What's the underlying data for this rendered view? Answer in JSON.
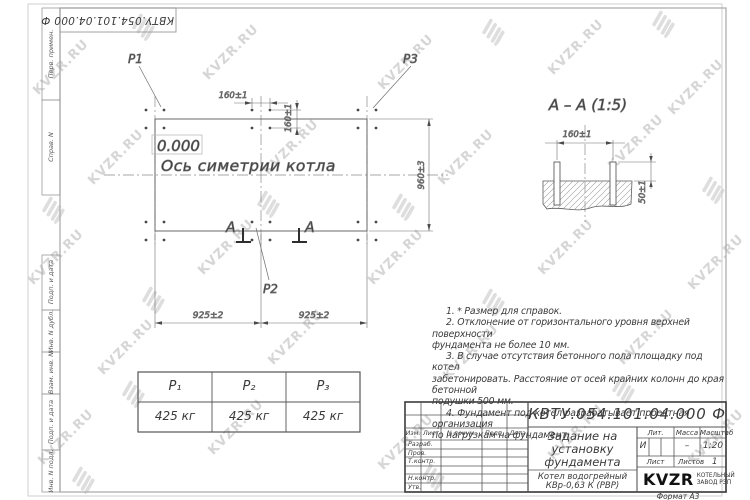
{
  "watermark": {
    "text": "KVZR.RU"
  },
  "corner_stamp": {
    "doc_number": "КВТУ.054.101.04.000  Ф"
  },
  "sidebar": {
    "labels": [
      "Перв. примен.",
      "Справ. N",
      "Подп. и дата",
      "Инв. N дубл.",
      "Взам. инв. N",
      "Подп. и дата",
      "Инв. N подл."
    ]
  },
  "plan": {
    "labels": {
      "p1": "P1",
      "p2": "P2",
      "p3": "P3",
      "level": "0.000",
      "axis": "Ось симетрии котла",
      "section_letter_left": "А",
      "section_letter_right": "А"
    },
    "dims": {
      "top_h": "160±1",
      "top_v": "160±1",
      "right_v": "960±3",
      "bottom_left": "925±2",
      "bottom_right": "925±2"
    }
  },
  "section": {
    "title": "А – А (1:5)",
    "dim_width": "160±1",
    "dim_height": "50±1"
  },
  "notes": {
    "lines": [
      "1. * Размер для справок.",
      "2. Отклонение от горизонтального уровня верхней поверхности",
      "фундамента не более 10 мм.",
      "3. В случае отсутствия бетонного пола площадку под котел",
      "забетонировать. Расстояние от осей крайних колонн до края бетонной",
      "подушки 500 мм.",
      "4. Фундамент под котел разрабатывает проектная организация",
      "по нагрузкам на фундамент."
    ]
  },
  "load_table": {
    "headers": [
      "P₁",
      "P₂",
      "P₃"
    ],
    "values": [
      "425 кг",
      "425 кг",
      "425 кг"
    ]
  },
  "title_block": {
    "doc_number": "КВТУ.054.101.04.000  Ф",
    "title_lines": [
      "Задание на",
      "установку",
      "фундамента"
    ],
    "product_lines": [
      "Котел водогрейный",
      "КВр-0,63 К (РВР)"
    ],
    "col_headers": [
      "Изм.",
      "Лист",
      "N докум.",
      "Подп.",
      "Дата"
    ],
    "row_labels": [
      "Разраб.",
      "Пров.",
      "Т.контр.",
      "Н.контр.",
      "Утв."
    ],
    "lit_label": "Лит.",
    "mass_label": "Масса",
    "scale_label": "Масштаб",
    "lit_value": "И",
    "mass_value": "–",
    "scale_value": "1:20",
    "sheet_label": "Лист",
    "sheets_label": "Листов",
    "sheets_value": "1",
    "logo_text": "KVZR",
    "logo_sub1": "КОТЕЛЬНЫЙ",
    "logo_sub2": "ЗАВОД РЭП",
    "format_label": "Формат А3"
  }
}
